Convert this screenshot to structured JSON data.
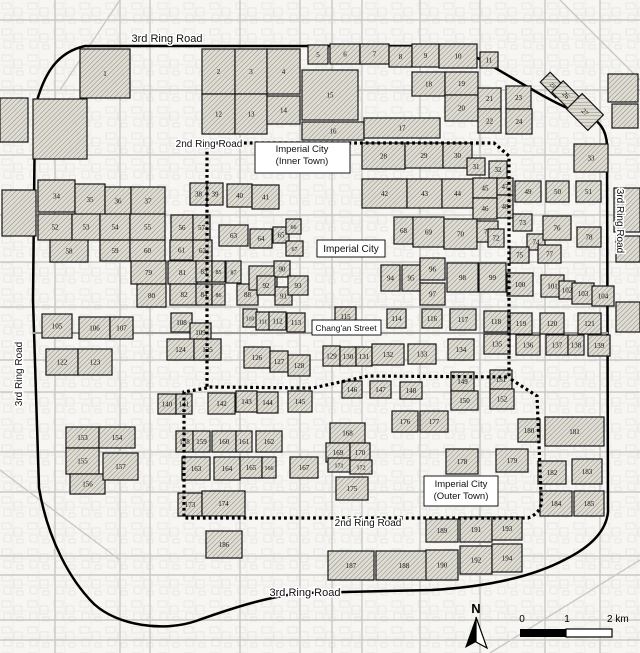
{
  "figure": {
    "type": "city-map",
    "description": "Historic-district map of Beijing: hatched numbered blocks inside ring roads"
  },
  "colors": {
    "background": "#f7f6f3",
    "texture_line": "#e3e2de",
    "street_gray": "#c9c8c4",
    "major_gray": "#a8a7a3",
    "block_fill": "#e0ddd4",
    "hatch_line": "#74716a",
    "block_stroke": "#151515",
    "road_black": "#000000",
    "label_ink": "#111111"
  },
  "labels": [
    {
      "id": "ring3-top",
      "text": "3rd Ring Road",
      "x": 167,
      "y": 42,
      "size": 11,
      "box": false,
      "rot": 0
    },
    {
      "id": "ring2-top",
      "text": "2nd Ring Road",
      "x": 209,
      "y": 147,
      "size": 10,
      "box": false,
      "rot": 0
    },
    {
      "id": "inner-town",
      "text": "Imperial City",
      "text2": "(Inner Town)",
      "x": 302,
      "y": 152,
      "size": 9.5,
      "box": true,
      "bx": 255,
      "by": 142,
      "bw": 95,
      "bh": 31,
      "rot": 0
    },
    {
      "id": "imperial-city",
      "text": "Imperial City",
      "x": 351,
      "y": 252,
      "size": 10,
      "box": true,
      "bx": 317,
      "by": 240,
      "bw": 68,
      "bh": 17,
      "rot": 0
    },
    {
      "id": "changan-street",
      "text": "Chang'an Street",
      "x": 346,
      "y": 331,
      "size": 8.5,
      "box": true,
      "bx": 312,
      "by": 320,
      "bw": 69,
      "bh": 15,
      "rot": 0
    },
    {
      "id": "outer-town",
      "text": "Imperial City",
      "text2": "(Outer Town)",
      "x": 461,
      "y": 487,
      "size": 9.5,
      "box": true,
      "bx": 424,
      "by": 476,
      "bw": 74,
      "bh": 30,
      "rot": 0
    },
    {
      "id": "ring2-bottom",
      "text": "2nd Ring Road",
      "x": 368,
      "y": 526,
      "size": 10,
      "box": false,
      "rot": 0
    },
    {
      "id": "ring3-bottom",
      "text": "3rd Ring Road",
      "x": 305,
      "y": 596,
      "size": 11,
      "box": false,
      "rot": 0
    },
    {
      "id": "ring3-left",
      "text": "3rd Ring Road",
      "x": 22,
      "y": 374,
      "size": 10,
      "box": false,
      "rot": -90
    },
    {
      "id": "ring3-right",
      "text": "3rd Ring Road",
      "x": 617,
      "y": 221,
      "size": 10,
      "box": false,
      "rot": 90
    }
  ],
  "north_arrow": {
    "label": "N",
    "x": 476,
    "y": 613,
    "apex_y": 617,
    "base_y": 648,
    "half_w": 11
  },
  "scale_bar": {
    "ticks": [
      "0",
      "1",
      "2 km"
    ],
    "tick_x": [
      522,
      567,
      607
    ],
    "text_y": 622,
    "bar_x": 520,
    "bar_y": 629,
    "bar_w": 92,
    "bar_h": 8
  },
  "roads": [
    {
      "name": "ring3-loop",
      "width": 2.5,
      "d": "M 35,108 C 44,72 58,52 85,46 L 455,46 C 492,64 542,98 572,110 C 594,116 606,124 607,145 L 608,512 C 606,532 590,547 566,559 C 540,573 498,586 432,590 L 302,593 C 268,597 238,606 196,621 C 164,632 118,626 94,604 C 70,580 48,540 39,488 L 33,300 Z"
    },
    {
      "name": "changan-axis",
      "width": 2,
      "color": "#9b9a96",
      "d": "M 33,333 L 608,333"
    }
  ],
  "boundaries": [
    {
      "name": "ring2-inner-town",
      "d": "M 207,146 L 207,387 L 313,388 L 368,376 L 509,377 L 509,156 L 494,143 L 207,143"
    },
    {
      "name": "ring2-outer-town",
      "d": "M 207,388 L 184,392 L 184,518 L 528,518 C 538,514 543,508 541,494 L 537,396 L 509,378"
    }
  ],
  "gridlines": {
    "h_y": [
      20,
      90,
      155,
      215,
      262,
      307,
      360,
      392,
      452,
      492,
      556,
      575,
      620,
      640
    ],
    "v_x": [
      55,
      120,
      150,
      240,
      300,
      332,
      362,
      420,
      480,
      545,
      600
    ]
  },
  "blocks": [
    [
      1,
      80,
      49,
      50,
      49,
      0
    ],
    [
      2,
      202,
      49,
      33,
      45,
      0
    ],
    [
      3,
      235,
      49,
      32,
      45,
      0
    ],
    [
      4,
      267,
      49,
      33,
      45,
      0
    ],
    [
      5,
      308,
      45,
      20,
      19,
      0
    ],
    [
      6,
      330,
      44,
      30,
      20,
      0
    ],
    [
      7,
      360,
      44,
      29,
      20,
      0
    ],
    [
      8,
      389,
      46,
      23,
      21,
      0
    ],
    [
      9,
      412,
      44,
      27,
      23,
      0
    ],
    [
      10,
      439,
      44,
      38,
      24,
      0
    ],
    [
      11,
      480,
      52,
      18,
      16,
      0
    ],
    [
      12,
      202,
      94,
      33,
      40,
      0
    ],
    [
      13,
      235,
      94,
      32,
      40,
      0
    ],
    [
      14,
      267,
      96,
      33,
      28,
      0
    ],
    [
      15,
      302,
      70,
      56,
      50,
      0
    ],
    [
      16,
      302,
      122,
      62,
      18,
      0
    ],
    [
      17,
      364,
      118,
      76,
      20,
      0
    ],
    [
      18,
      412,
      72,
      33,
      24,
      0
    ],
    [
      19,
      445,
      72,
      33,
      23,
      0
    ],
    [
      20,
      445,
      95,
      33,
      26,
      0
    ],
    [
      21,
      478,
      88,
      23,
      21,
      0
    ],
    [
      22,
      478,
      109,
      23,
      24,
      0
    ],
    [
      23,
      506,
      86,
      25,
      23,
      0
    ],
    [
      24,
      506,
      109,
      26,
      25,
      0
    ],
    [
      25,
      542,
      78,
      22,
      14,
      45
    ],
    [
      26,
      554,
      87,
      24,
      16,
      45
    ],
    [
      27,
      570,
      101,
      30,
      22,
      45
    ],
    [
      28,
      362,
      143,
      43,
      26,
      0
    ],
    [
      29,
      405,
      143,
      38,
      25,
      0
    ],
    [
      30,
      443,
      143,
      29,
      25,
      0
    ],
    [
      31,
      467,
      158,
      18,
      17,
      0
    ],
    [
      32,
      489,
      161,
      18,
      17,
      0
    ],
    [
      33,
      574,
      144,
      34,
      28,
      0
    ],
    [
      34,
      38,
      180,
      37,
      32,
      0
    ],
    [
      35,
      75,
      184,
      30,
      31,
      0
    ],
    [
      36,
      105,
      187,
      26,
      28,
      0
    ],
    [
      37,
      131,
      187,
      34,
      28,
      0
    ],
    [
      38,
      190,
      183,
      17,
      22,
      0
    ],
    [
      39,
      207,
      183,
      16,
      22,
      0
    ],
    [
      40,
      227,
      184,
      25,
      23,
      0
    ],
    [
      41,
      252,
      185,
      27,
      24,
      0
    ],
    [
      42,
      362,
      179,
      45,
      29,
      0
    ],
    [
      43,
      407,
      179,
      35,
      29,
      0
    ],
    [
      44,
      442,
      179,
      31,
      29,
      0
    ],
    [
      45,
      473,
      178,
      24,
      20,
      0
    ],
    [
      46,
      473,
      198,
      24,
      21,
      0
    ],
    [
      47,
      497,
      178,
      16,
      17,
      0
    ],
    [
      48,
      497,
      195,
      16,
      23,
      0
    ],
    [
      49,
      515,
      181,
      26,
      21,
      0
    ],
    [
      50,
      546,
      181,
      23,
      21,
      0
    ],
    [
      51,
      576,
      181,
      25,
      21,
      0
    ],
    [
      52,
      38,
      214,
      34,
      26,
      0
    ],
    [
      53,
      72,
      214,
      28,
      26,
      0
    ],
    [
      54,
      100,
      214,
      30,
      26,
      0
    ],
    [
      55,
      130,
      214,
      35,
      26,
      0
    ],
    [
      56,
      171,
      215,
      22,
      25,
      0
    ],
    [
      57,
      193,
      215,
      17,
      25,
      0
    ],
    [
      58,
      50,
      240,
      38,
      22,
      0
    ],
    [
      59,
      100,
      240,
      30,
      21,
      0
    ],
    [
      60,
      130,
      240,
      35,
      21,
      0
    ],
    [
      61,
      170,
      240,
      23,
      20,
      0
    ],
    [
      62,
      193,
      240,
      19,
      21,
      0
    ],
    [
      63,
      219,
      225,
      29,
      21,
      0
    ],
    [
      64,
      250,
      229,
      22,
      19,
      0
    ],
    [
      65,
      273,
      227,
      16,
      16,
      0
    ],
    [
      66,
      286,
      219,
      15,
      15,
      0
    ],
    [
      67,
      286,
      241,
      17,
      15,
      0
    ],
    [
      68,
      394,
      217,
      19,
      27,
      0
    ],
    [
      69,
      413,
      217,
      31,
      30,
      0
    ],
    [
      70,
      444,
      219,
      33,
      30,
      0
    ],
    [
      71,
      477,
      221,
      21,
      21,
      0
    ],
    [
      72,
      488,
      229,
      16,
      18,
      0
    ],
    [
      73,
      513,
      214,
      19,
      17,
      0
    ],
    [
      74,
      527,
      234,
      18,
      16,
      0
    ],
    [
      75,
      510,
      247,
      19,
      16,
      0
    ],
    [
      76,
      543,
      216,
      28,
      24,
      0
    ],
    [
      77,
      538,
      245,
      23,
      18,
      0
    ],
    [
      78,
      577,
      227,
      24,
      20,
      0
    ],
    [
      79,
      131,
      261,
      35,
      23,
      0
    ],
    [
      80,
      137,
      284,
      29,
      23,
      0
    ],
    [
      81,
      168,
      261,
      29,
      23,
      0
    ],
    [
      82,
      170,
      284,
      28,
      21,
      0
    ],
    [
      83,
      196,
      261,
      16,
      21,
      0
    ],
    [
      84,
      196,
      284,
      16,
      21,
      0
    ],
    [
      85,
      212,
      261,
      13,
      21,
      0
    ],
    [
      86,
      212,
      284,
      13,
      21,
      0
    ],
    [
      87,
      226,
      261,
      15,
      22,
      0
    ],
    [
      88,
      237,
      284,
      21,
      21,
      0
    ],
    [
      89,
      249,
      266,
      28,
      24,
      0
    ],
    [
      90,
      274,
      261,
      16,
      16,
      0
    ],
    [
      91,
      275,
      287,
      17,
      18,
      0
    ],
    [
      92,
      257,
      276,
      18,
      19,
      0
    ],
    [
      93,
      288,
      276,
      20,
      19,
      0
    ],
    [
      94,
      381,
      265,
      19,
      26,
      0
    ],
    [
      95,
      402,
      265,
      18,
      26,
      0
    ],
    [
      96,
      420,
      258,
      25,
      22,
      0
    ],
    [
      97,
      420,
      283,
      25,
      22,
      0
    ],
    [
      98,
      447,
      263,
      31,
      29,
      0
    ],
    [
      99,
      479,
      263,
      27,
      29,
      0
    ],
    [
      100,
      507,
      273,
      26,
      23,
      0
    ],
    [
      101,
      541,
      275,
      23,
      22,
      0
    ],
    [
      102,
      559,
      281,
      16,
      18,
      0
    ],
    [
      103,
      572,
      283,
      22,
      21,
      0
    ],
    [
      104,
      592,
      286,
      22,
      20,
      0
    ],
    [
      105,
      42,
      314,
      30,
      24,
      0
    ],
    [
      106,
      79,
      317,
      31,
      22,
      0
    ],
    [
      107,
      110,
      317,
      23,
      22,
      0
    ],
    [
      108,
      171,
      313,
      21,
      19,
      0
    ],
    [
      109,
      190,
      323,
      21,
      19,
      0
    ],
    [
      110,
      243,
      309,
      14,
      18,
      0
    ],
    [
      111,
      256,
      312,
      14,
      18,
      0
    ],
    [
      112,
      269,
      312,
      17,
      18,
      0
    ],
    [
      113,
      287,
      313,
      18,
      19,
      0
    ],
    [
      114,
      387,
      309,
      19,
      19,
      0
    ],
    [
      115,
      335,
      307,
      21,
      19,
      0
    ],
    [
      116,
      422,
      309,
      20,
      19,
      0
    ],
    [
      117,
      450,
      309,
      26,
      21,
      0
    ],
    [
      118,
      484,
      311,
      24,
      21,
      0
    ],
    [
      119,
      510,
      313,
      22,
      21,
      0
    ],
    [
      120,
      540,
      313,
      24,
      21,
      0
    ],
    [
      121,
      578,
      313,
      23,
      21,
      0
    ],
    [
      122,
      46,
      349,
      32,
      26,
      0
    ],
    [
      123,
      78,
      349,
      34,
      26,
      0
    ],
    [
      124,
      167,
      339,
      27,
      21,
      0
    ],
    [
      125,
      194,
      339,
      27,
      21,
      0
    ],
    [
      126,
      244,
      347,
      26,
      21,
      0
    ],
    [
      127,
      270,
      351,
      18,
      21,
      0
    ],
    [
      128,
      288,
      355,
      22,
      21,
      0
    ],
    [
      129,
      323,
      346,
      17,
      20,
      0
    ],
    [
      130,
      340,
      347,
      16,
      19,
      0
    ],
    [
      131,
      356,
      347,
      16,
      19,
      0
    ],
    [
      132,
      372,
      344,
      32,
      21,
      0
    ],
    [
      133,
      408,
      344,
      28,
      20,
      0
    ],
    [
      134,
      448,
      339,
      26,
      21,
      0
    ],
    [
      135,
      484,
      334,
      26,
      20,
      0
    ],
    [
      136,
      516,
      335,
      24,
      20,
      0
    ],
    [
      137,
      546,
      335,
      22,
      20,
      0
    ],
    [
      138,
      568,
      335,
      16,
      20,
      0
    ],
    [
      139,
      588,
      335,
      22,
      21,
      0
    ],
    [
      140,
      158,
      394,
      18,
      20,
      0
    ],
    [
      141,
      176,
      394,
      16,
      20,
      0
    ],
    [
      142,
      208,
      393,
      27,
      21,
      0
    ],
    [
      143,
      236,
      391,
      21,
      21,
      0
    ],
    [
      144,
      257,
      392,
      21,
      21,
      0
    ],
    [
      145,
      288,
      391,
      24,
      21,
      0
    ],
    [
      146,
      342,
      381,
      20,
      17,
      0
    ],
    [
      147,
      370,
      381,
      21,
      17,
      0
    ],
    [
      148,
      400,
      382,
      22,
      17,
      0
    ],
    [
      149,
      451,
      372,
      23,
      19,
      0
    ],
    [
      150,
      451,
      391,
      27,
      19,
      0
    ],
    [
      151,
      490,
      370,
      22,
      19,
      0
    ],
    [
      152,
      490,
      389,
      24,
      20,
      0
    ],
    [
      153,
      66,
      427,
      33,
      21,
      0
    ],
    [
      154,
      99,
      427,
      36,
      21,
      0
    ],
    [
      155,
      66,
      448,
      33,
      26,
      0
    ],
    [
      156,
      70,
      474,
      35,
      20,
      0
    ],
    [
      157,
      103,
      453,
      35,
      27,
      0
    ],
    [
      158,
      176,
      431,
      17,
      21,
      0
    ],
    [
      159,
      193,
      431,
      17,
      21,
      0
    ],
    [
      160,
      212,
      431,
      24,
      21,
      0
    ],
    [
      161,
      236,
      431,
      16,
      21,
      0
    ],
    [
      162,
      256,
      431,
      26,
      21,
      0
    ],
    [
      163,
      182,
      457,
      28,
      23,
      0
    ],
    [
      164,
      214,
      457,
      26,
      23,
      0
    ],
    [
      165,
      240,
      457,
      22,
      21,
      0
    ],
    [
      166,
      262,
      457,
      14,
      21,
      0
    ],
    [
      167,
      290,
      457,
      28,
      21,
      0
    ],
    [
      168,
      330,
      423,
      35,
      20,
      0
    ],
    [
      169,
      326,
      443,
      24,
      19,
      0
    ],
    [
      170,
      350,
      443,
      20,
      19,
      0
    ],
    [
      171,
      328,
      458,
      22,
      14,
      0
    ],
    [
      172,
      350,
      460,
      22,
      14,
      0
    ],
    [
      173,
      178,
      493,
      24,
      23,
      0
    ],
    [
      174,
      202,
      491,
      43,
      25,
      0
    ],
    [
      175,
      336,
      477,
      32,
      23,
      0
    ],
    [
      176,
      392,
      411,
      26,
      21,
      0
    ],
    [
      177,
      420,
      411,
      28,
      21,
      0
    ],
    [
      178,
      446,
      449,
      32,
      25,
      0
    ],
    [
      179,
      496,
      449,
      32,
      23,
      0
    ],
    [
      180,
      518,
      419,
      22,
      23,
      0
    ],
    [
      181,
      545,
      417,
      59,
      29,
      0
    ],
    [
      182,
      538,
      461,
      28,
      23,
      0
    ],
    [
      183,
      572,
      459,
      30,
      25,
      0
    ],
    [
      184,
      540,
      491,
      32,
      25,
      0
    ],
    [
      185,
      574,
      491,
      30,
      25,
      0
    ],
    [
      186,
      206,
      531,
      36,
      27,
      0
    ],
    [
      187,
      328,
      551,
      46,
      29,
      0
    ],
    [
      188,
      376,
      551,
      56,
      29,
      0
    ],
    [
      189,
      426,
      519,
      32,
      23,
      0
    ],
    [
      190,
      426,
      550,
      32,
      30,
      0
    ],
    [
      191,
      460,
      517,
      32,
      25,
      0
    ],
    [
      192,
      460,
      546,
      32,
      28,
      0
    ],
    [
      193,
      492,
      517,
      30,
      23,
      0
    ],
    [
      194,
      492,
      544,
      30,
      28,
      0
    ]
  ],
  "extra_blocks": [
    [
      0,
      98,
      28,
      44
    ],
    [
      33,
      99,
      54,
      60
    ],
    [
      2,
      190,
      34,
      46
    ],
    [
      608,
      74,
      30,
      28
    ],
    [
      612,
      104,
      26,
      24
    ],
    [
      614,
      188,
      26,
      44
    ],
    [
      616,
      236,
      24,
      26
    ],
    [
      616,
      302,
      24,
      30
    ]
  ]
}
